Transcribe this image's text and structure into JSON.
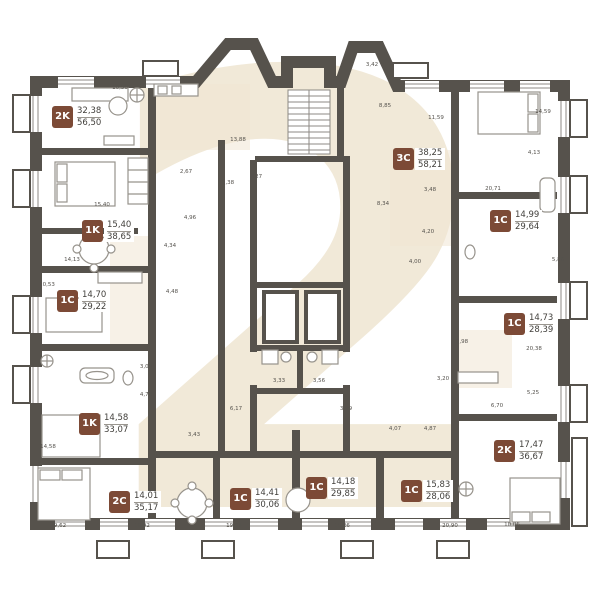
{
  "page": {
    "watermark": "2"
  },
  "colors": {
    "wall": "#56524c",
    "badge": "#7c4a36",
    "watermark_cream": "#f1e9d8",
    "floor_tint": "#f0e6d4",
    "line": "#97938c",
    "text": "#413f3b"
  },
  "apartments": [
    {
      "type": "2K",
      "room_area": "32,38",
      "total_area": "56,50"
    },
    {
      "type": "1K",
      "room_area": "15,40",
      "total_area": "38,65"
    },
    {
      "type": "1C",
      "room_area": "14,70",
      "total_area": "29,22"
    },
    {
      "type": "1K",
      "room_area": "14,58",
      "total_area": "33,07"
    },
    {
      "type": "2C",
      "room_area": "14,01",
      "total_area": "35,17"
    },
    {
      "type": "3C",
      "room_area": "38,25",
      "total_area": "58,21"
    },
    {
      "type": "1C",
      "room_area": "14,99",
      "total_area": "29,64"
    },
    {
      "type": "1C",
      "room_area": "14,73",
      "total_area": "28,39"
    },
    {
      "type": "2K",
      "room_area": "17,47",
      "total_area": "36,67"
    },
    {
      "type": "1C",
      "room_area": "14,41",
      "total_area": "30,06"
    },
    {
      "type": "1C",
      "room_area": "14,18",
      "total_area": "29,85"
    },
    {
      "type": "1C",
      "room_area": "15,83",
      "total_area": "28,06"
    }
  ],
  "dimensions": [
    "10,50",
    "13,88",
    "4,27",
    "3,38",
    "3,42",
    "8,85",
    "11,59",
    "14,59",
    "4,13",
    "2,67",
    "4,96",
    "15,40",
    "14,13",
    "4,34",
    "20,53",
    "4,48",
    "20,71",
    "8,34",
    "3,48",
    "4,20",
    "5,86",
    "4,00",
    "20,38",
    "5,25",
    "2,98",
    "3,20",
    "6,70",
    "4,87",
    "4,07",
    "3,09",
    "4,73",
    "6,17",
    "3,43",
    "14,58",
    "3,33",
    "3,56",
    "3,99",
    "9,62",
    "19,92",
    "19,96",
    "15,26",
    "20,90",
    "10,06"
  ]
}
